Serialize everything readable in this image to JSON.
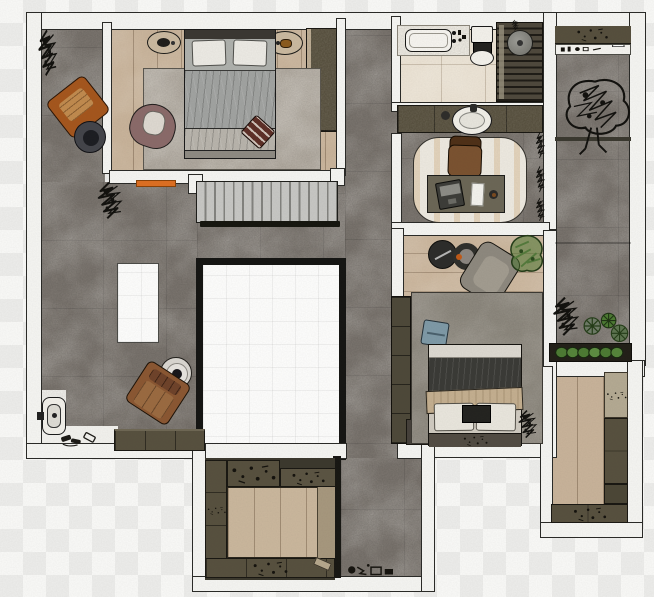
{
  "scene": {
    "kind": "architectural floor plan render, top view",
    "background": "transparency checkerboard",
    "visible_text": "none"
  },
  "palette": {
    "checker_light": "#f8f8f6",
    "checker_dark": "#ececea",
    "wall_fill": "#f4f4f1",
    "wall_outline": "#2a2a27",
    "concrete_floor": "#7b756f",
    "wood_floor": "#c7b299",
    "tile_floor": "#e9e0d1",
    "marble_floor": "#f1f0ec",
    "cabinet_dark": "#57503e",
    "void_frame": "#151513",
    "rug_master": "#b2aba1",
    "rug_bedroom2": "#8f8a80",
    "rug_study": "#ece8df",
    "bed1_duvet": "#a0a2a0",
    "bed2_blanket": "#3a3a36",
    "bed2_throw": "#c3ae8f",
    "armchair_orange": "#a4561d",
    "armchair_leather": "#8a5732",
    "armchair_mauve": "#8a6a69",
    "armchair_gray": "#8d887e",
    "pouf_red": "#5d2f27",
    "cushion_blue": "#7e99a6",
    "plant_dark": "#12110e",
    "plant_green": "#4c7a33",
    "stair_tread": "#c6c6c3",
    "door_marker_orange": "#dd6f22"
  },
  "rooms": [
    {
      "id": "master-bedroom",
      "label": "Master Bedroom",
      "furniture": [
        "double bed",
        "two nightstands with lamps",
        "area rug",
        "mauve armchair",
        "red ottoman",
        "dark wardrobe"
      ]
    },
    {
      "id": "terrace",
      "label": "Terrace",
      "furniture": [
        "orange lounge chair",
        "round side table",
        "plants"
      ]
    },
    {
      "id": "living-area",
      "label": "Living Area",
      "furniture": [
        "leather lounge chair",
        "round side table",
        "white island counter",
        "sideboard",
        "plants"
      ]
    },
    {
      "id": "staircase",
      "label": "Staircase"
    },
    {
      "id": "void",
      "label": "Open Void"
    },
    {
      "id": "bathroom",
      "label": "Bathroom",
      "furniture": [
        "bathtub with marble deck",
        "toilet",
        "slatted walk-in shower",
        "rain shower head"
      ]
    },
    {
      "id": "study",
      "label": "Study",
      "furniture": [
        "desk",
        "laptop",
        "paper",
        "cup",
        "office chair",
        "rounded rug"
      ]
    },
    {
      "id": "bedroom-2",
      "label": "Bedroom 2",
      "furniture": [
        "double bed",
        "blue cushion",
        "round coffee tables",
        "gray armchair",
        "green plant",
        "tall wardrobe",
        "nightstand",
        "plants"
      ]
    },
    {
      "id": "balcony",
      "label": "Balcony",
      "furniture": [
        "shelf with bottles",
        "large tree plant",
        "succulents",
        "planter box with shrubs"
      ]
    },
    {
      "id": "walk-in-closet-bottom",
      "label": "Walk-in Closet (bottom)",
      "furniture": [
        "wardrobe cabinets",
        "shoe shelf"
      ]
    },
    {
      "id": "walk-in-closet-right",
      "label": "Walk-in Closet (right)",
      "furniture": [
        "wardrobe cabinets"
      ]
    },
    {
      "id": "entry-wc",
      "label": "Entry / WC",
      "furniture": [
        "wall-hung toilet",
        "scattered shoes"
      ]
    },
    {
      "id": "corridor",
      "label": "Corridor",
      "furniture": [
        "small pots"
      ]
    }
  ],
  "fixtures": {
    "vanity": [
      "counter",
      "round basin",
      "soap dish"
    ],
    "doors": [
      "orange door marker at master bedroom"
    ]
  }
}
